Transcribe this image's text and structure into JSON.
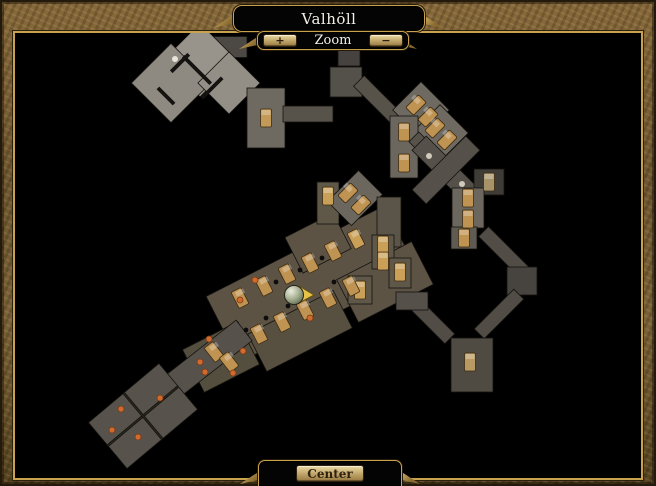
{
  "window": {
    "title": "Valhöll"
  },
  "zoom_controls": {
    "label": "Zoom",
    "zoom_in": "+",
    "zoom_out": "−"
  },
  "center_button": {
    "label": "Center"
  },
  "colors": {
    "frame_gold": "#c9a24e",
    "plaque_bg": "#040404",
    "button_face": "#c7ad72",
    "text_light": "#f2efe6",
    "text_dark": "#2e2110",
    "map_bg": "#000000",
    "bed": "#bf9352",
    "bed_gold": "#caa058",
    "dot_orange": "#d06a2e",
    "player_arrow": "#e6c44a"
  },
  "map": {
    "shapes": [
      [
        226,
        47,
        42,
        21,
        0,
        "#4c4945"
      ],
      [
        200,
        60,
        52,
        52,
        45,
        "#98948c"
      ],
      [
        171,
        83,
        56,
        56,
        45,
        "#8e8a82"
      ],
      [
        229,
        83,
        44,
        44,
        45,
        "#938f87"
      ],
      [
        197,
        70,
        38,
        3,
        45,
        "#151311"
      ],
      [
        212,
        88,
        28,
        3,
        -45,
        "#151311"
      ],
      [
        180,
        63,
        24,
        3,
        -45,
        "#151311"
      ],
      [
        166,
        96,
        22,
        3,
        45,
        "#151311"
      ],
      [
        266,
        118,
        38,
        60,
        0,
        "#6e6a61"
      ],
      [
        308,
        114,
        50,
        16,
        0,
        "#57534b"
      ],
      [
        346,
        82,
        32,
        30,
        0,
        "#54504a"
      ],
      [
        349,
        56,
        22,
        20,
        0,
        "#454240"
      ],
      [
        378,
        100,
        54,
        15,
        45,
        "#57534b"
      ],
      [
        421,
        110,
        40,
        40,
        45,
        "#6e6a61"
      ],
      [
        440,
        133,
        40,
        40,
        45,
        "#6e6a61"
      ],
      [
        404,
        147,
        28,
        62,
        0,
        "#6b675f"
      ],
      [
        428,
        151,
        40,
        14,
        45,
        "#57534b"
      ],
      [
        446,
        170,
        76,
        20,
        45,
        "#55514a"
      ],
      [
        446,
        170,
        76,
        20,
        -45,
        "#55514a"
      ],
      [
        489,
        182,
        30,
        26,
        0,
        "#3f3c38"
      ],
      [
        468,
        208,
        32,
        40,
        0,
        "#6b675f"
      ],
      [
        464,
        238,
        26,
        22,
        0,
        "#5f5b53"
      ],
      [
        504,
        252,
        58,
        14,
        45,
        "#514d46"
      ],
      [
        522,
        281,
        30,
        28,
        0,
        "#474440"
      ],
      [
        499,
        314,
        56,
        14,
        -45,
        "#514d46"
      ],
      [
        430,
        319,
        56,
        14,
        45,
        "#514d46"
      ],
      [
        472,
        365,
        42,
        54,
        0,
        "#4f4a42"
      ],
      [
        312,
        284,
        200,
        74,
        -27,
        "#5c5345"
      ],
      [
        318,
        243,
        54,
        40,
        -27,
        "#5c5345"
      ],
      [
        300,
        331,
        96,
        42,
        -27,
        "#575041"
      ],
      [
        221,
        357,
        62,
        48,
        -27,
        "#544e3e"
      ],
      [
        385,
        282,
        84,
        48,
        -27,
        "#5c5345"
      ],
      [
        196,
        368,
        122,
        26,
        -38,
        "#56524b"
      ],
      [
        143,
        416,
        92,
        60,
        -40,
        "#57534c"
      ],
      [
        143,
        416,
        90,
        2,
        -40,
        "#2a2822"
      ],
      [
        143,
        416,
        2,
        58,
        -40,
        "#2a2822"
      ],
      [
        328,
        203,
        22,
        42,
        0,
        "#5f5849"
      ],
      [
        355,
        198,
        34,
        44,
        45,
        "#6b675f"
      ],
      [
        389,
        222,
        24,
        50,
        0,
        "#5a5548"
      ],
      [
        383,
        252,
        22,
        34,
        0,
        "#5f5849"
      ],
      [
        400,
        273,
        22,
        30,
        0,
        "#5f5849"
      ],
      [
        360,
        290,
        24,
        28,
        0,
        "#5f5849"
      ],
      [
        412,
        301,
        32,
        18,
        0,
        "#55514a"
      ]
    ],
    "beds": [
      [
        266,
        118,
        0,
        "#c49a58"
      ],
      [
        416,
        105,
        45,
        null
      ],
      [
        428,
        117,
        45,
        null
      ],
      [
        435,
        128,
        45,
        null
      ],
      [
        447,
        140,
        45,
        null
      ],
      [
        404,
        132,
        0,
        null
      ],
      [
        404,
        163,
        0,
        null
      ],
      [
        489,
        182,
        0,
        "#a89368"
      ],
      [
        468,
        198,
        0,
        null
      ],
      [
        468,
        219,
        0,
        null
      ],
      [
        464,
        238,
        0,
        null
      ],
      [
        470,
        362,
        0,
        "#b89a62"
      ],
      [
        328,
        196,
        0,
        "#caa058"
      ],
      [
        348,
        193,
        45,
        null
      ],
      [
        361,
        205,
        45,
        null
      ],
      [
        383,
        245,
        0,
        "#caa058"
      ],
      [
        383,
        261,
        0,
        "#caa058"
      ],
      [
        400,
        272,
        0,
        "#caa058"
      ],
      [
        360,
        290,
        0,
        "#caa058"
      ],
      [
        240,
        298,
        -27,
        null
      ],
      [
        264,
        286,
        -27,
        null
      ],
      [
        287,
        274,
        -27,
        null
      ],
      [
        310,
        263,
        -27,
        null
      ],
      [
        333,
        251,
        -27,
        null
      ],
      [
        356,
        239,
        -27,
        "#caa058"
      ],
      [
        259,
        334,
        -27,
        null
      ],
      [
        282,
        322,
        -27,
        null
      ],
      [
        305,
        310,
        -27,
        null
      ],
      [
        328,
        298,
        -27,
        null
      ],
      [
        351,
        286,
        -27,
        null
      ],
      [
        214,
        352,
        -38,
        null
      ],
      [
        229,
        362,
        -38,
        null
      ]
    ],
    "dots": [
      [
        175,
        59,
        "#e8e4da"
      ],
      [
        255,
        280,
        null
      ],
      [
        310,
        318,
        null
      ],
      [
        240,
        300,
        null
      ],
      [
        209,
        339,
        null
      ],
      [
        243,
        351,
        null
      ],
      [
        200,
        362,
        null
      ],
      [
        233,
        373,
        null
      ],
      [
        121,
        409,
        null
      ],
      [
        138,
        437,
        null
      ],
      [
        160,
        398,
        null
      ],
      [
        112,
        430,
        null
      ],
      [
        205,
        372,
        null
      ],
      [
        429,
        156,
        "#cfcabc"
      ],
      [
        462,
        184,
        "#cfcabc"
      ],
      [
        276,
        282,
        "#0e0d0b"
      ],
      [
        300,
        270,
        "#0e0d0b"
      ],
      [
        322,
        258,
        "#0e0d0b"
      ],
      [
        288,
        306,
        "#0e0d0b"
      ],
      [
        334,
        282,
        "#0e0d0b"
      ],
      [
        266,
        318,
        "#0e0d0b"
      ],
      [
        246,
        330,
        "#0e0d0b"
      ]
    ],
    "player": {
      "x": 294,
      "y": 295
    }
  }
}
